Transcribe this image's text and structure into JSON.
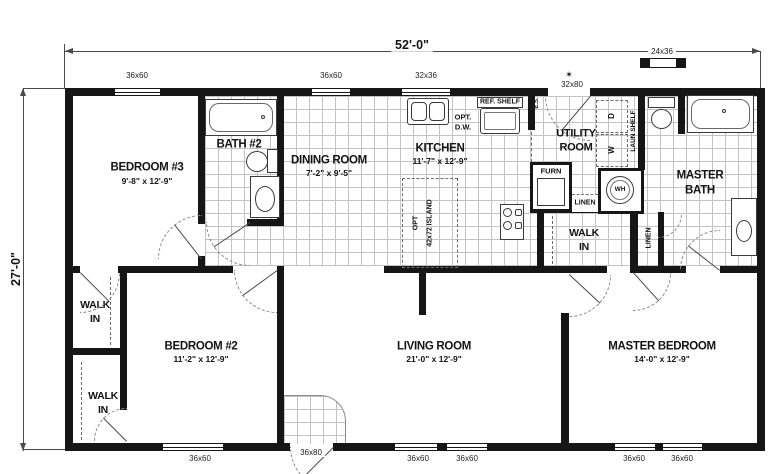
{
  "plan": {
    "width_label": "52'-0\"",
    "height_label": "27'-0\""
  },
  "rooms": {
    "bedroom3": {
      "name": "BEDROOM #3",
      "size": "9'-8\" x 12'-9\""
    },
    "bath2": {
      "name": "BATH #2"
    },
    "dining": {
      "name": "DINING ROOM",
      "size": "7'-2\" x 9'-5\""
    },
    "kitchen": {
      "name": "KITCHEN",
      "size": "11'-7\" x 12'-9\""
    },
    "utility": {
      "line1": "UTILITY",
      "line2": "ROOM"
    },
    "master_bath": {
      "line1": "MASTER",
      "line2": "BATH"
    },
    "master_walk_in": {
      "line1": "WALK",
      "line2": "IN"
    },
    "walk_in_upper": {
      "line1": "WALK",
      "line2": "IN"
    },
    "walk_in_lower": {
      "line1": "WALK",
      "line2": "IN"
    },
    "bedroom2": {
      "name": "BEDROOM #2",
      "size": "11'-2\" x 12'-9\""
    },
    "living": {
      "name": "LIVING ROOM",
      "size": "21'-0\" x 12'-9\""
    },
    "master_bedroom": {
      "name": "MASTER BEDROOM",
      "size": "14'-0\" x 12'-9\""
    }
  },
  "labels": {
    "ref_shelf": "REF. SHELF",
    "opt": "OPT.",
    "dw": "D.W.",
    "island_opt": "OPT",
    "island_size": "42x72 ISLAND",
    "furn": "FURN",
    "wh": "WH",
    "linen_hall": "LINEN",
    "linen_bath": "LINEN",
    "laun_shelf": "LAUN SHELF",
    "dryer": "D",
    "washer": "W",
    "es": "E.S.",
    "door_star": "✶"
  },
  "openings": {
    "top_window_1": "36x60",
    "top_window_2": "36x60",
    "top_window_3": "32x36",
    "entry_door": "32x80",
    "end_window": "24x36",
    "bottom_window_1": "36x60",
    "front_door": "36x80",
    "bottom_window_2": "36x60",
    "bottom_window_3": "36x60",
    "bottom_window_4": "36x60",
    "bottom_window_5": "36x60"
  }
}
